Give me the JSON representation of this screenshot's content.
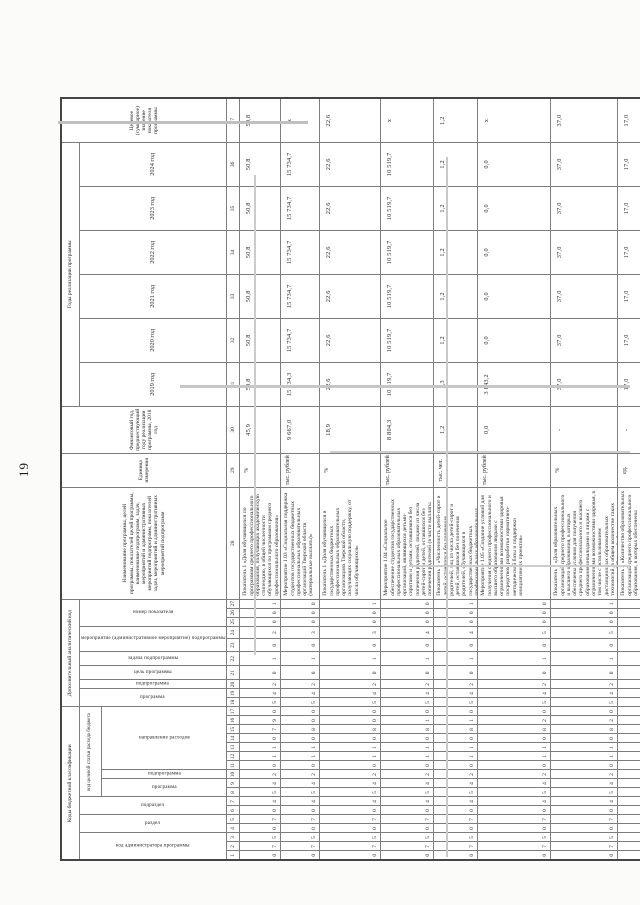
{
  "page_number": "19",
  "scan": {
    "artifact_color": "#c3c3c3",
    "border_color": "#7d7d7d",
    "text_color": "#242424"
  },
  "table": {
    "header": {
      "group_budget_codes": "Коды бюджетной классификации",
      "group_analytic_code": "Дополнительный аналитический код",
      "budget_sub": [
        "код администратора программы",
        "раздел",
        "подраздел",
        "код целевой статьи расхода бюджета"
      ],
      "target_article_sub": [
        "программа",
        "подпрограмма",
        "направление расходов"
      ],
      "analytic_sub": [
        "программа",
        "подпрограмма",
        "цель программы",
        "задача подпрограммы",
        "мероприятие (административное мероприятие) подпрограммы",
        "номер показателя"
      ],
      "col_name": "Наименование программы, целей программы, показателей целей программы, наименование подпрограмм, задач, мероприятий и административных мероприятий подпрограмм, показателей задач, мероприятий и административных мероприятий подпрограмм",
      "col_unit": "Единица измерения",
      "col_prior_year": "Финансовый год, предшествующий году реализации программы, 2018 год",
      "group_years": "Годы реализации программы",
      "years": [
        "2019 год",
        "2020 год",
        "2021 год",
        "2022 год",
        "2023 год",
        "2024 год"
      ],
      "col_target": "Целевое (суммарное) значение показателя программы",
      "column_numbers": [
        "1",
        "2",
        "3",
        "4",
        "5",
        "6",
        "7",
        "8",
        "9",
        "10",
        "11",
        "12",
        "13",
        "14",
        "15",
        "16",
        "17",
        "18",
        "19",
        "20",
        "21",
        "22",
        "23",
        "24",
        "25",
        "26",
        "27",
        "28",
        "29",
        "30",
        "31",
        "32",
        "33",
        "34",
        "35",
        "36",
        "37"
      ]
    },
    "rows": [
      {
        "name": "Показатель 1 «Доля обучающихся по программам среднего профессионального образования, получающих академическую стипендию, в общей численности обучающихся по программам среднего профессионального образования»",
        "codes": "075070454201107905420102001",
        "unit": "%",
        "values": [
          "45,9",
          "50,8",
          "50,8",
          "50,8",
          "50,8",
          "50,8",
          "50,8",
          "50,8"
        ]
      },
      {
        "name": "Мероприятие 1.03 «Социальная поддержка студентов государственных бюджетных профессиональных образовательных организаций Тверской области (материальные выплаты)»",
        "codes": "075070454201108005420103000",
        "unit": "тыс. рублей",
        "values": [
          "9 667,0",
          "15 734,3",
          "15 734,7",
          "15 734,7",
          "15 734,7",
          "15 734,7",
          "15 734,7",
          "х"
        ]
      },
      {
        "name": "Показатель 1 «Доля обучающихся в государственных бюджетных профессиональных образовательных организациях Тверской области, получающих социальную поддержку, от числа обучающихся»",
        "codes": "075070454201108005420103001",
        "unit": "%",
        "values": [
          "18,9",
          "22,6",
          "22,6",
          "22,6",
          "22,6",
          "22,6",
          "22,6",
          "22,6"
        ]
      },
      {
        "name": "Мероприятие 1.04 «Социальное обеспечение студентов государственных профессиональных образовательных организаций, являющихся детьми-сиротами и детьми, оставшимися без попечения родителей, лицами из числа детей-сирот и детей, оставшихся без попечения родителей (в части выплаты государственной социальной стипендии)»",
        "codes": "075070454201108105420104000",
        "unit": "тыс. рублей",
        "values": [
          "8 804,3",
          "10 519,7",
          "10 519,7",
          "10 519,7",
          "10 519,7",
          "10 519,7",
          "10 519,7",
          "х"
        ]
      },
      {
        "name": "Показатель 1 «Численность детей-сирот и детей, оставшихся без попечения родителей, лиц из числа детей-сирот и детей, оставшихся без попечения родителей, обучающихся в государственных бюджетных профессиональных образовательных организациях, получающих социальную стипендию»",
        "codes": "075070454201108105420104001",
        "unit": "тыс. чел.",
        "values": [
          "1,2",
          "1,3",
          "1,2",
          "1,2",
          "1,2",
          "1,2",
          "1,2",
          "1,2"
        ]
      },
      {
        "name": "Мероприятие 1.05 «Создание условий для получения среднего профессионального и высшего образования людьми с ограниченными возможностями здоровья посредством разработки нормативно-методической базы и поддержки инициативных проектов»",
        "codes": "075070454201108205420105000",
        "unit": "тыс. рублей",
        "values": [
          "0,0",
          "3 843,2",
          "0,0",
          "0,0",
          "0,0",
          "0,0",
          "0,0",
          "х"
        ]
      },
      {
        "name": "Показатель 1 «Доля образовательных организаций среднего профессионального и высшего образования, в которых обеспечены условия для получения среднего профессионального и высшего образования инвалидами и лицами с ограниченными возможностями здоровья, в том числе с использованием дистанционных образовательных технологий, в общем количестве таких организаций Тверской области»",
        "codes": "075070454201108205420105001",
        "unit": "%",
        "values": [
          "-",
          "37,0",
          "37,0",
          "37,0",
          "37,0",
          "37,0",
          "37,0",
          "37,0"
        ]
      },
      {
        "name": "Показатель 2 «Количество образовательных организаций среднего профессионального образования, в которых обеспечены условия для получения среднего профессионального образования инвалидами и лицами с ограниченными возможностями здоровья, в том числе с использованием дистанционных образовательных технологий»",
        "codes": "075070454201108205420105002",
        "unit": "ед.",
        "values": [
          "-",
          "17,0",
          "17,0",
          "17,0",
          "17,0",
          "17,0",
          "17,0",
          "17,0"
        ]
      }
    ]
  }
}
